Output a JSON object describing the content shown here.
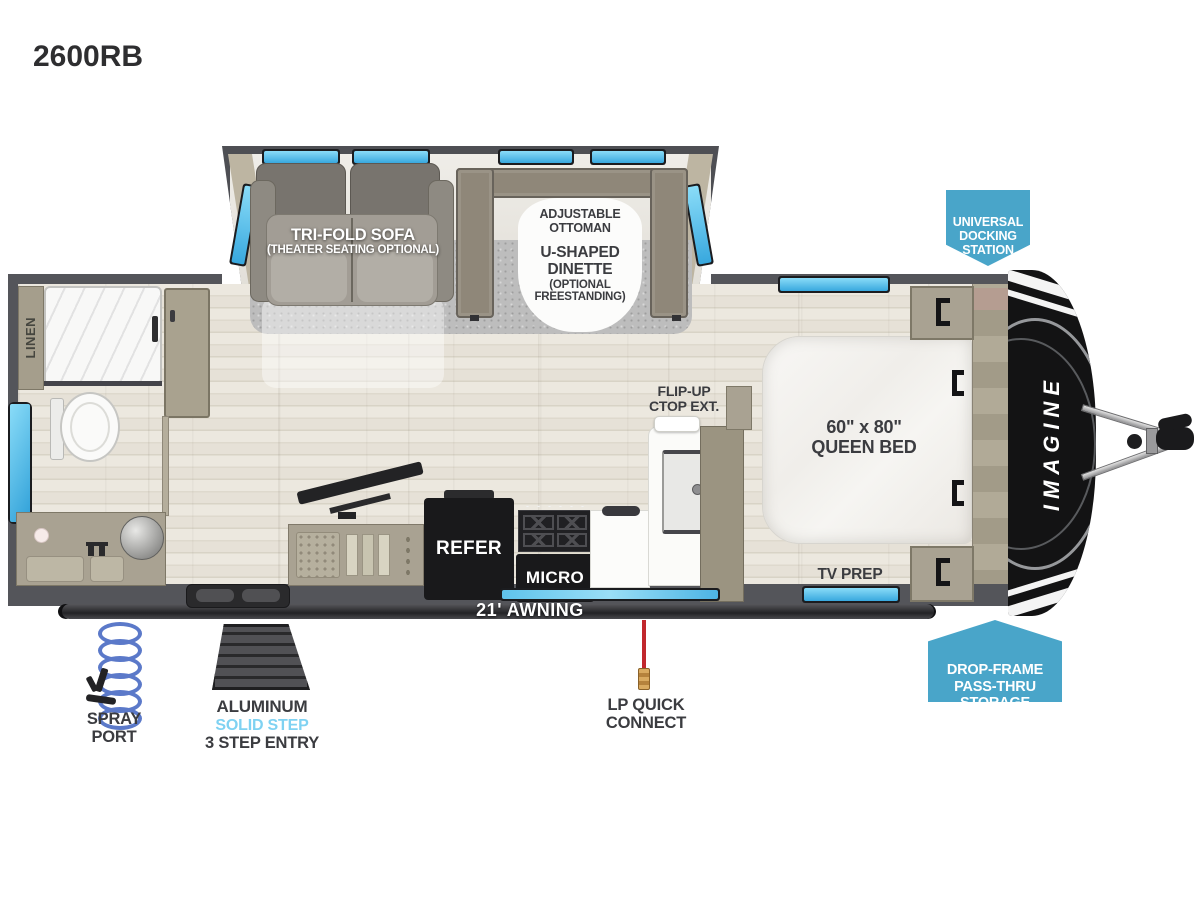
{
  "title": "2600RB",
  "colors": {
    "wall": "#54555a",
    "window_blue": "#45b6e8",
    "callout_blue": "#49a5c9",
    "label_dark": "#3b3c40",
    "step_brand_blue": "#7fd2f2",
    "lp_red": "#c1272d",
    "cabinet_tan": "#a9a292",
    "floor_light": "#e9e5dc"
  },
  "slideout": {
    "sofa_label": "TRI-FOLD SOFA",
    "sofa_sublabel": "(THEATER SEATING OPTIONAL)",
    "ottoman_label": "ADJUSTABLE\nOTTOMAN",
    "dinette_label": "U-SHAPED\nDINETTE",
    "dinette_sublabel": "(OPTIONAL\nFREESTANDING)"
  },
  "bathroom": {
    "linen_label": "LINEN"
  },
  "kitchen": {
    "flip_up_label": "FLIP-UP\nCTOP EXT.",
    "refer_label": "REFER",
    "micro_label": "MICRO"
  },
  "bedroom": {
    "bed_label": "60\" x 80\"\nQUEEN BED",
    "tv_prep_label": "TV PREP"
  },
  "exterior": {
    "awning_label": "21' AWNING",
    "spray_port_label": "SPRAY\nPORT",
    "step_material": "ALUMINUM",
    "step_brand": "SOLID STEP",
    "step_entry": "3 STEP ENTRY",
    "lp_label": "LP QUICK\nCONNECT",
    "brand_label": "IMAGINE"
  },
  "callouts": {
    "docking": "UNIVERSAL\nDOCKING\nSTATION",
    "storage": "DROP-FRAME\nPASS-THRU\nSTORAGE"
  }
}
